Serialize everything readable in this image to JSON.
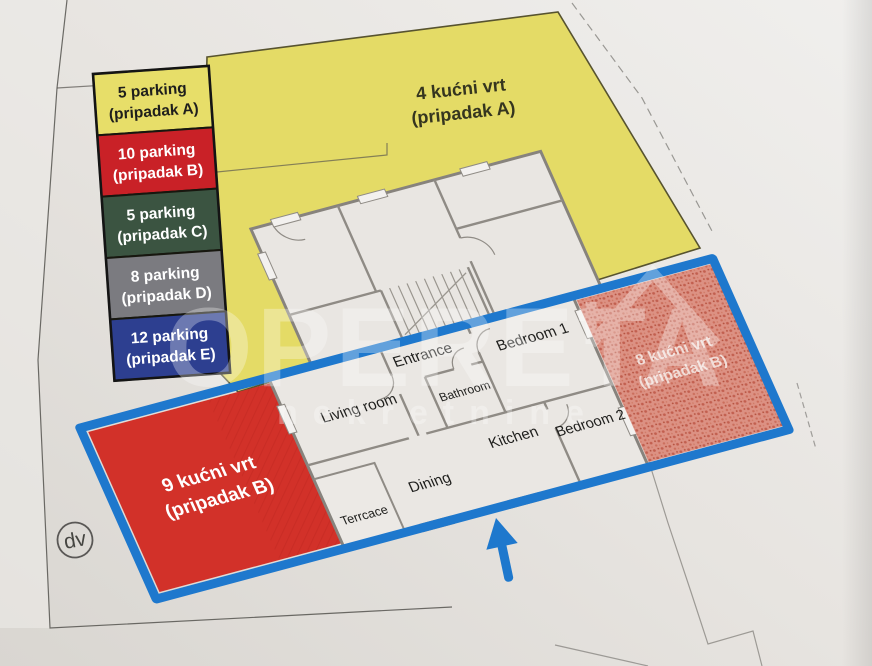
{
  "legend": {
    "items": [
      {
        "line1": "5 parking",
        "line2": "(pripadak A)",
        "color": "#e7de69",
        "text_color": "#1e1e1c"
      },
      {
        "line1": "10 parking",
        "line2": "(pripadak B)",
        "color": "#c92127",
        "text_color": "#ffffff"
      },
      {
        "line1": "5 parking",
        "line2": "(pripadak C)",
        "color": "#3b5441",
        "text_color": "#ffffff"
      },
      {
        "line1": "8 parking",
        "line2": "(pripadak D)",
        "color": "#7b7b80",
        "text_color": "#ffffff"
      },
      {
        "line1": "12 parking",
        "line2": "(pripadak E)",
        "color": "#2d3f90",
        "text_color": "#ffffff"
      }
    ]
  },
  "gardens": {
    "garden4": {
      "line1": "4 kućni vrt",
      "line2": "(pripadak A)",
      "fill": "#e4db66",
      "text_color": "#35351f"
    },
    "garden8": {
      "line1": "8 kućni vrt",
      "line2": "(pripadak B)",
      "fill": "#dc9183",
      "text_color": "#f6ece8"
    },
    "garden9": {
      "line1": "9 kućni vrt",
      "line2": "(pripadak B)",
      "fill": "#d23129",
      "text_color": "#ffffff"
    }
  },
  "rooms": [
    {
      "label": "Entrance"
    },
    {
      "label": "Bedroom 1"
    },
    {
      "label": "Bathroom"
    },
    {
      "label": "Living room"
    },
    {
      "label": "Bedroom 2"
    },
    {
      "label": "Kitchen"
    },
    {
      "label": "Dining"
    },
    {
      "label": "Terrcace"
    }
  ],
  "marker": {
    "label": "dv"
  },
  "watermark": {
    "brand": "OPERETA",
    "sub": "nekretnine"
  },
  "icons": {
    "north_arrow": "up-arrow"
  },
  "colors": {
    "outline": "#1e78cd",
    "paper": "#e7e4e0",
    "wall": "#8f8b85"
  }
}
